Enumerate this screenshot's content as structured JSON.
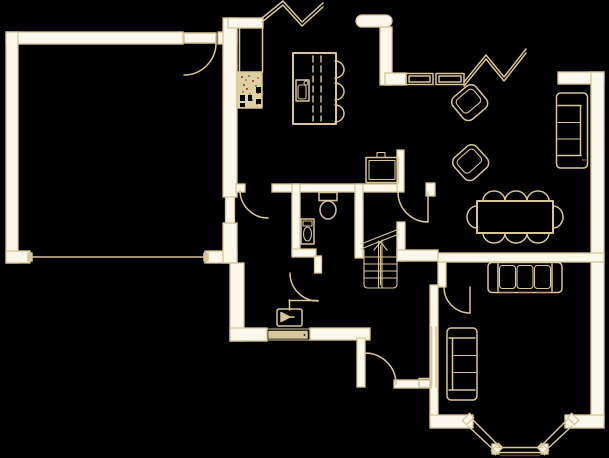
{
  "palette": {
    "background": "#000000",
    "line": "#d6c69a",
    "wall_fill": "#fbf7ea",
    "accent_red": "#c96a55",
    "cooker_fill": "#ddd0a4",
    "speckle_red": "#b5523c",
    "speckle_green": "#7d8f4a",
    "speckle_gold": "#c09a3e",
    "ink_black": "#000000"
  },
  "drawing": {
    "type": "floor-plan",
    "symbols": [
      "garage-room",
      "garage-door",
      "garage-side-door",
      "party-wall-door",
      "kitchen-area",
      "kitchen-chimney",
      "cooker",
      "kitchen-island",
      "island-sink",
      "island-stools",
      "wall-break-left",
      "wall-break-right",
      "window-top",
      "window-side",
      "wc-room",
      "toilet",
      "basin",
      "fridge-unit",
      "hallway",
      "front-door",
      "entry-marker",
      "stairs",
      "stairs-up-arrow",
      "dining-table",
      "dining-chairs",
      "armchair",
      "sofa",
      "lounge-room",
      "bay-window",
      "radiator-stub",
      "door-swing"
    ]
  }
}
